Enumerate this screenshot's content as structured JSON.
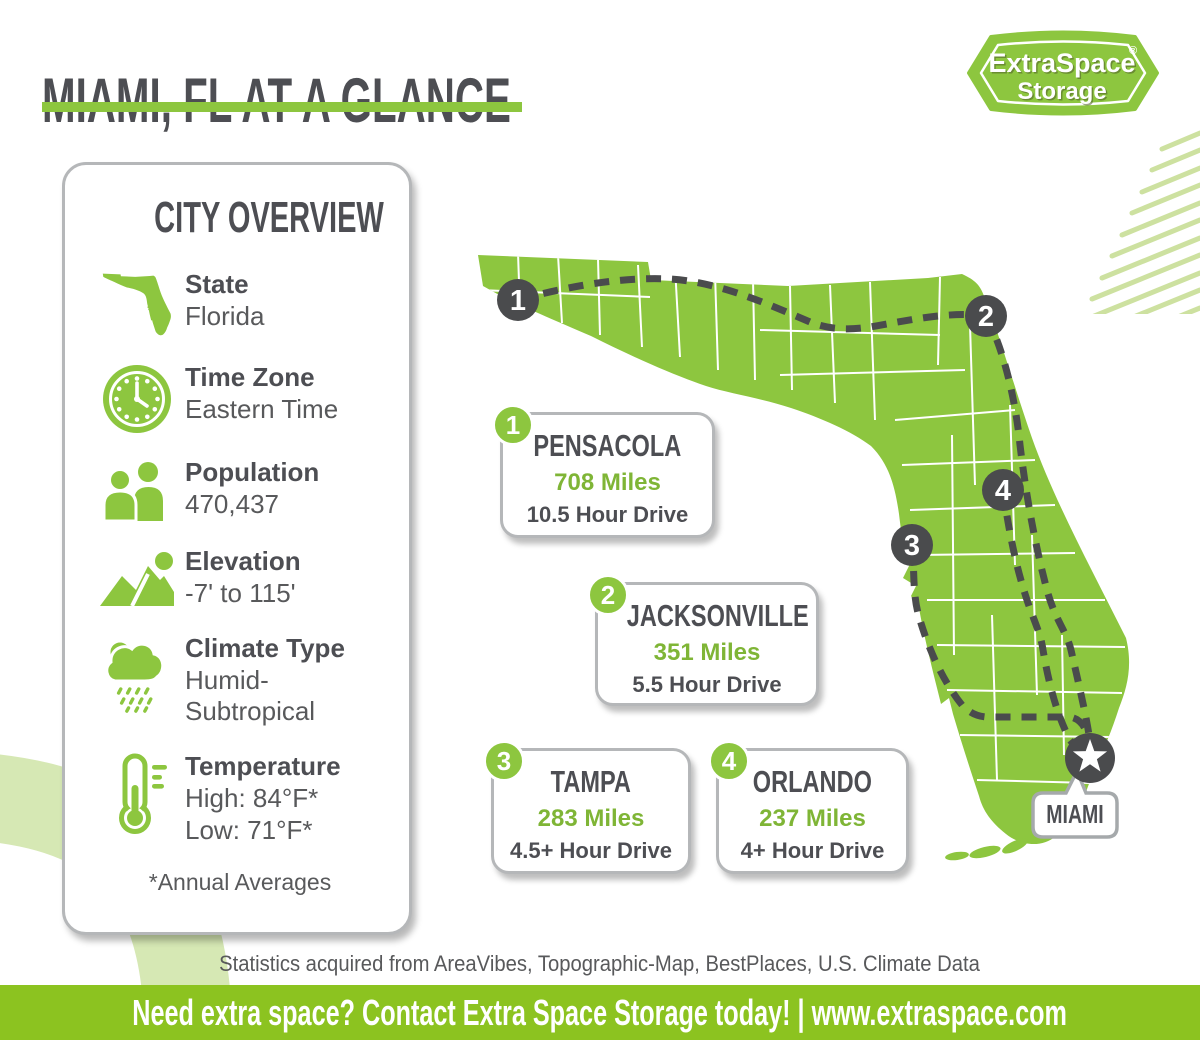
{
  "header": {
    "title": "MIAMI, FL AT A GLANCE"
  },
  "logo": {
    "line1": "ExtraSpace",
    "reg": "®",
    "line2": "Storage"
  },
  "colors": {
    "brand_green": "#8dc63f",
    "footer_green": "#8cc320",
    "miles_green": "#7fb536",
    "light_green_decor": "#d6e8b4",
    "hatch_green": "#cde1a0",
    "dark_text": "#4d4e53",
    "body_text": "#58595b",
    "marker_dark": "#4a4b4d",
    "card_border": "#b5b7b9"
  },
  "city_overview": {
    "title": "CITY OVERVIEW",
    "rows": [
      {
        "icon": "florida-state-icon",
        "label": "State",
        "value": "Florida",
        "value2": ""
      },
      {
        "icon": "clock-icon",
        "label": "Time Zone",
        "value": "Eastern Time",
        "value2": ""
      },
      {
        "icon": "population-icon",
        "label": "Population",
        "value": "470,437",
        "value2": ""
      },
      {
        "icon": "elevation-icon",
        "label": "Elevation",
        "value": "-7' to 115'",
        "value2": ""
      },
      {
        "icon": "climate-icon",
        "label": "Climate Type",
        "value": "Humid-",
        "value2": "Subtropical"
      },
      {
        "icon": "thermometer-icon",
        "label": "Temperature",
        "value": "High: 84°F*",
        "value2": "Low: 71°F*"
      }
    ],
    "footnote": "*Annual Averages"
  },
  "map": {
    "markers": [
      "1",
      "2",
      "3",
      "4"
    ],
    "miami_label": "MIAMI"
  },
  "distance_cards": [
    {
      "number": "1",
      "city": "PENSACOLA",
      "miles": "708 Miles",
      "drive": "10.5 Hour Drive"
    },
    {
      "number": "2",
      "city": "JACKSONVILLE",
      "miles": "351 Miles",
      "drive": "5.5 Hour Drive"
    },
    {
      "number": "3",
      "city": "TAMPA",
      "miles": "283 Miles",
      "drive": "4.5+ Hour Drive"
    },
    {
      "number": "4",
      "city": "ORLANDO",
      "miles": "237 Miles",
      "drive": "4+ Hour Drive"
    }
  ],
  "footer": {
    "disclaimer": "Statistics acquired from AreaVibes, Topographic-Map, BestPlaces, U.S. Climate Data",
    "bar_text": "Need extra space? Contact Extra Space Storage today! | www.extraspace.com"
  }
}
